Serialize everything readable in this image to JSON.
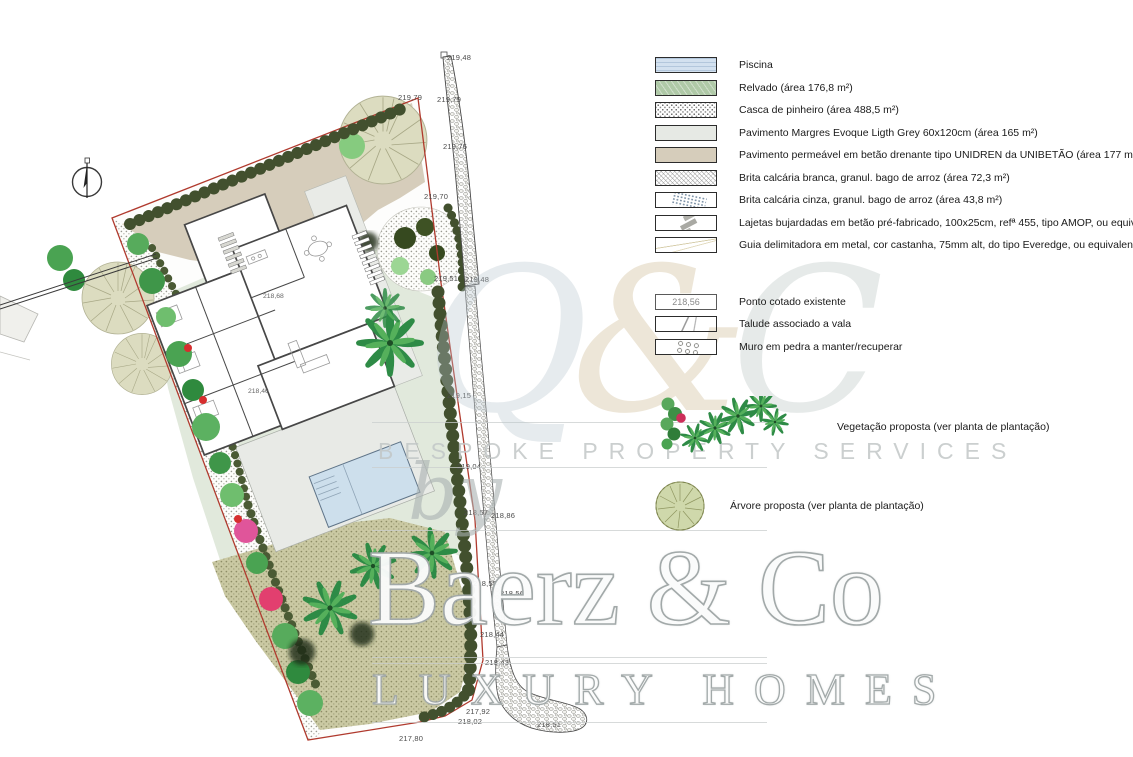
{
  "legend": {
    "materials": [
      {
        "swatch": "piscina",
        "label": "Piscina"
      },
      {
        "swatch": "relvado",
        "label": "Relvado (área 176,8 m²)"
      },
      {
        "swatch": "casca",
        "label": "Casca de pinheiro (área 488,5 m²)"
      },
      {
        "swatch": "margres",
        "label": "Pavimento Margres Evoque Ligth Grey 60x120cm (área 165 m²)"
      },
      {
        "swatch": "permeavel",
        "label": "Pavimento permeável em betão drenante tipo UNIDREN da UNIBETÃO (área 177 m²)"
      },
      {
        "swatch": "brita-branca",
        "label": "Brita calcária branca, granul. bago de arroz (área 72,3 m²)"
      },
      {
        "swatch": "brita-cinza",
        "label": "Brita calcária cinza, granul. bago de arroz (área 43,8 m²)"
      },
      {
        "swatch": "lajetas",
        "label": "Lajetas bujardadas em betão pré-fabricado, 100x25cm, refª 455, tipo AMOP, ou equivalente"
      },
      {
        "swatch": "guia",
        "label": "Guia delimitadora em metal, cor castanha, 75mm alt, do tipo Everedge, ou equivalente"
      }
    ],
    "annotations": [
      {
        "swatch": "ponto",
        "swatch_text": "218,56",
        "label": "Ponto cotado existente"
      },
      {
        "swatch": "talude",
        "label": "Talude associado a vala"
      },
      {
        "swatch": "muro",
        "label": "Muro em pedra a manter/recuperar"
      }
    ],
    "veg_label": "Vegetação proposta (ver planta de plantação)",
    "tree_label": "Árvore proposta (ver planta de plantação)"
  },
  "plan": {
    "house_labels": {
      "upper": "218,68",
      "lower": "218,46"
    },
    "elevations": [
      {
        "t": "219,48",
        "x": 447,
        "y": 53
      },
      {
        "t": "219,79",
        "x": 398,
        "y": 93
      },
      {
        "t": "219,79",
        "x": 437,
        "y": 95
      },
      {
        "t": "219,76",
        "x": 443,
        "y": 142
      },
      {
        "t": "219,70",
        "x": 424,
        "y": 192
      },
      {
        "t": "219,51",
        "x": 434,
        "y": 274
      },
      {
        "t": "219,48",
        "x": 465,
        "y": 275
      },
      {
        "t": "219,15",
        "x": 447,
        "y": 391
      },
      {
        "t": "219,04",
        "x": 457,
        "y": 462
      },
      {
        "t": "218,57",
        "x": 464,
        "y": 508
      },
      {
        "t": "218,86",
        "x": 491,
        "y": 511
      },
      {
        "t": "218,55",
        "x": 473,
        "y": 579
      },
      {
        "t": "218,56",
        "x": 500,
        "y": 589
      },
      {
        "t": "218,44",
        "x": 480,
        "y": 630
      },
      {
        "t": "218,43",
        "x": 485,
        "y": 658
      },
      {
        "t": "217,92",
        "x": 466,
        "y": 707
      },
      {
        "t": "218,02",
        "x": 458,
        "y": 717
      },
      {
        "t": "217,80",
        "x": 399,
        "y": 734
      },
      {
        "t": "218,51",
        "x": 537,
        "y": 720
      }
    ]
  },
  "watermark": {
    "monogram_q": "Q",
    "monogram_amp": "&",
    "monogram_c": "C",
    "tagline": "BESPOKE PROPERTY SERVICES",
    "by": "by",
    "brand": "Baerz & Co",
    "subbrand": "LUXURY HOMES"
  },
  "colors": {
    "pool": "#cddfec",
    "lawn": "#e1e9dc",
    "driveway": "#d6cdbb",
    "terrace": "#e8eae6",
    "hedge": "#42502e",
    "boundary": "#b03a2e",
    "pine_bark_garden": "#cac9a3"
  }
}
